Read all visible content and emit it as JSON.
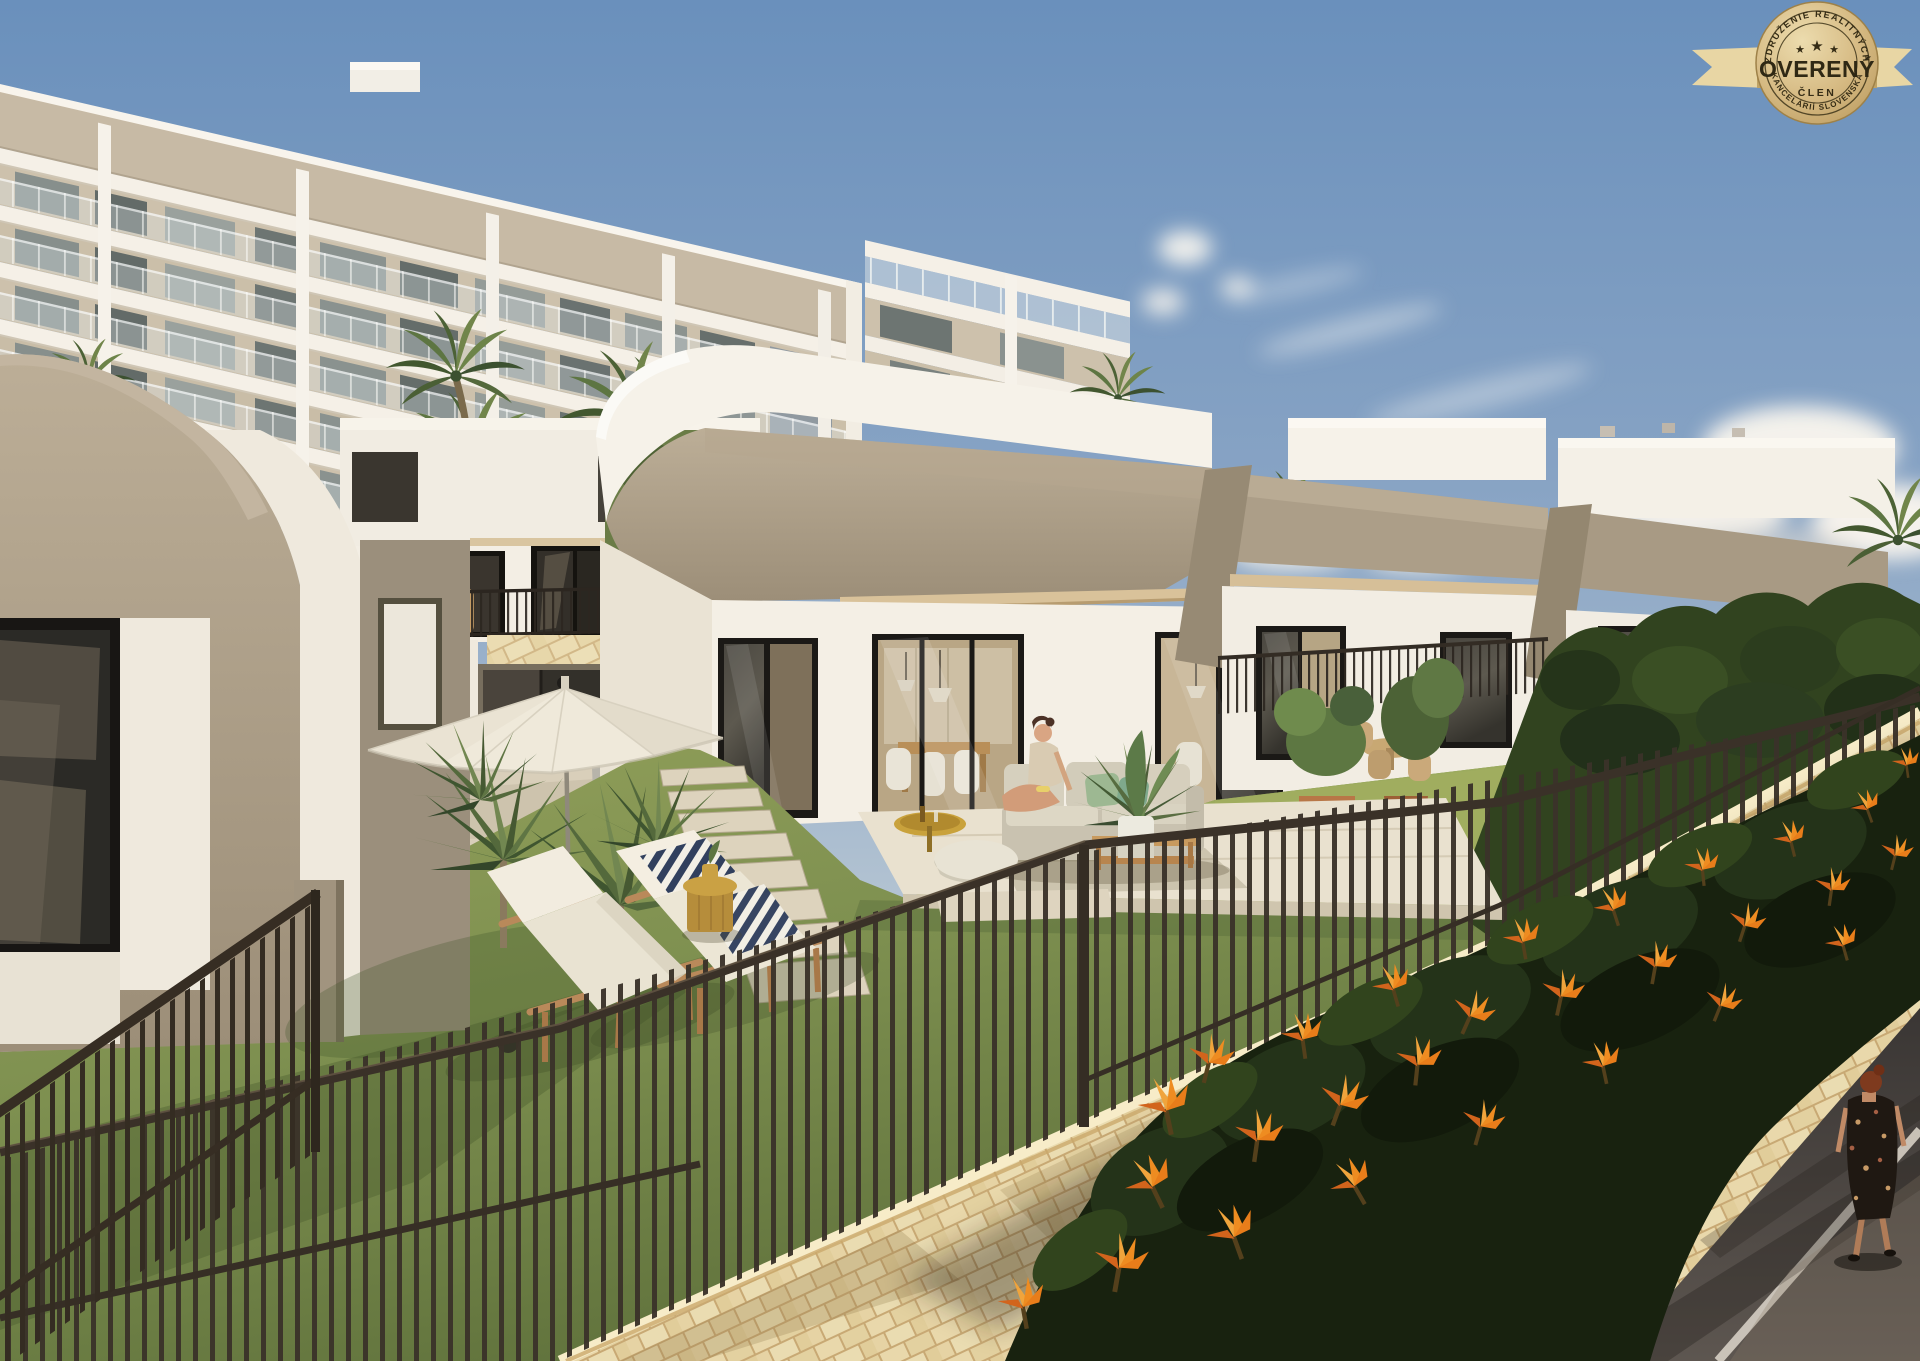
{
  "image": {
    "kind": "3d-architectural-render",
    "alt": "Modern residential development render: white single-storey villas with private lawns, sun loungers and parasol, large apartment building behind, bronze railings and a natural stone wall with orange bird-of-paradise flowers along a road in the foreground"
  },
  "badge": {
    "arc_top": "ZDRUŽENIE REALITNÝCH",
    "arc_bottom": "KANCELÁRIÍ SLOVENSKA",
    "title": "OVERENÝ",
    "subtitle": "ČLEN",
    "star": "★",
    "colors": {
      "gold_light": "#EAD9AC",
      "gold": "#D3B77E",
      "gold_deep": "#B3934F",
      "ink": "#30290F",
      "ribbon": "#E8D6A4"
    }
  },
  "palette": {
    "sky_top": "#6A90BC",
    "sky_horizon": "#DFE0DD",
    "wall_white": "#F4EFE6",
    "taupe": "#AB9D87",
    "grass": "#7B8D4C",
    "stone_wall": "#EADAAE",
    "fence": "#3A3228",
    "flower_orange": "#EE8C21",
    "road": "#474140"
  }
}
